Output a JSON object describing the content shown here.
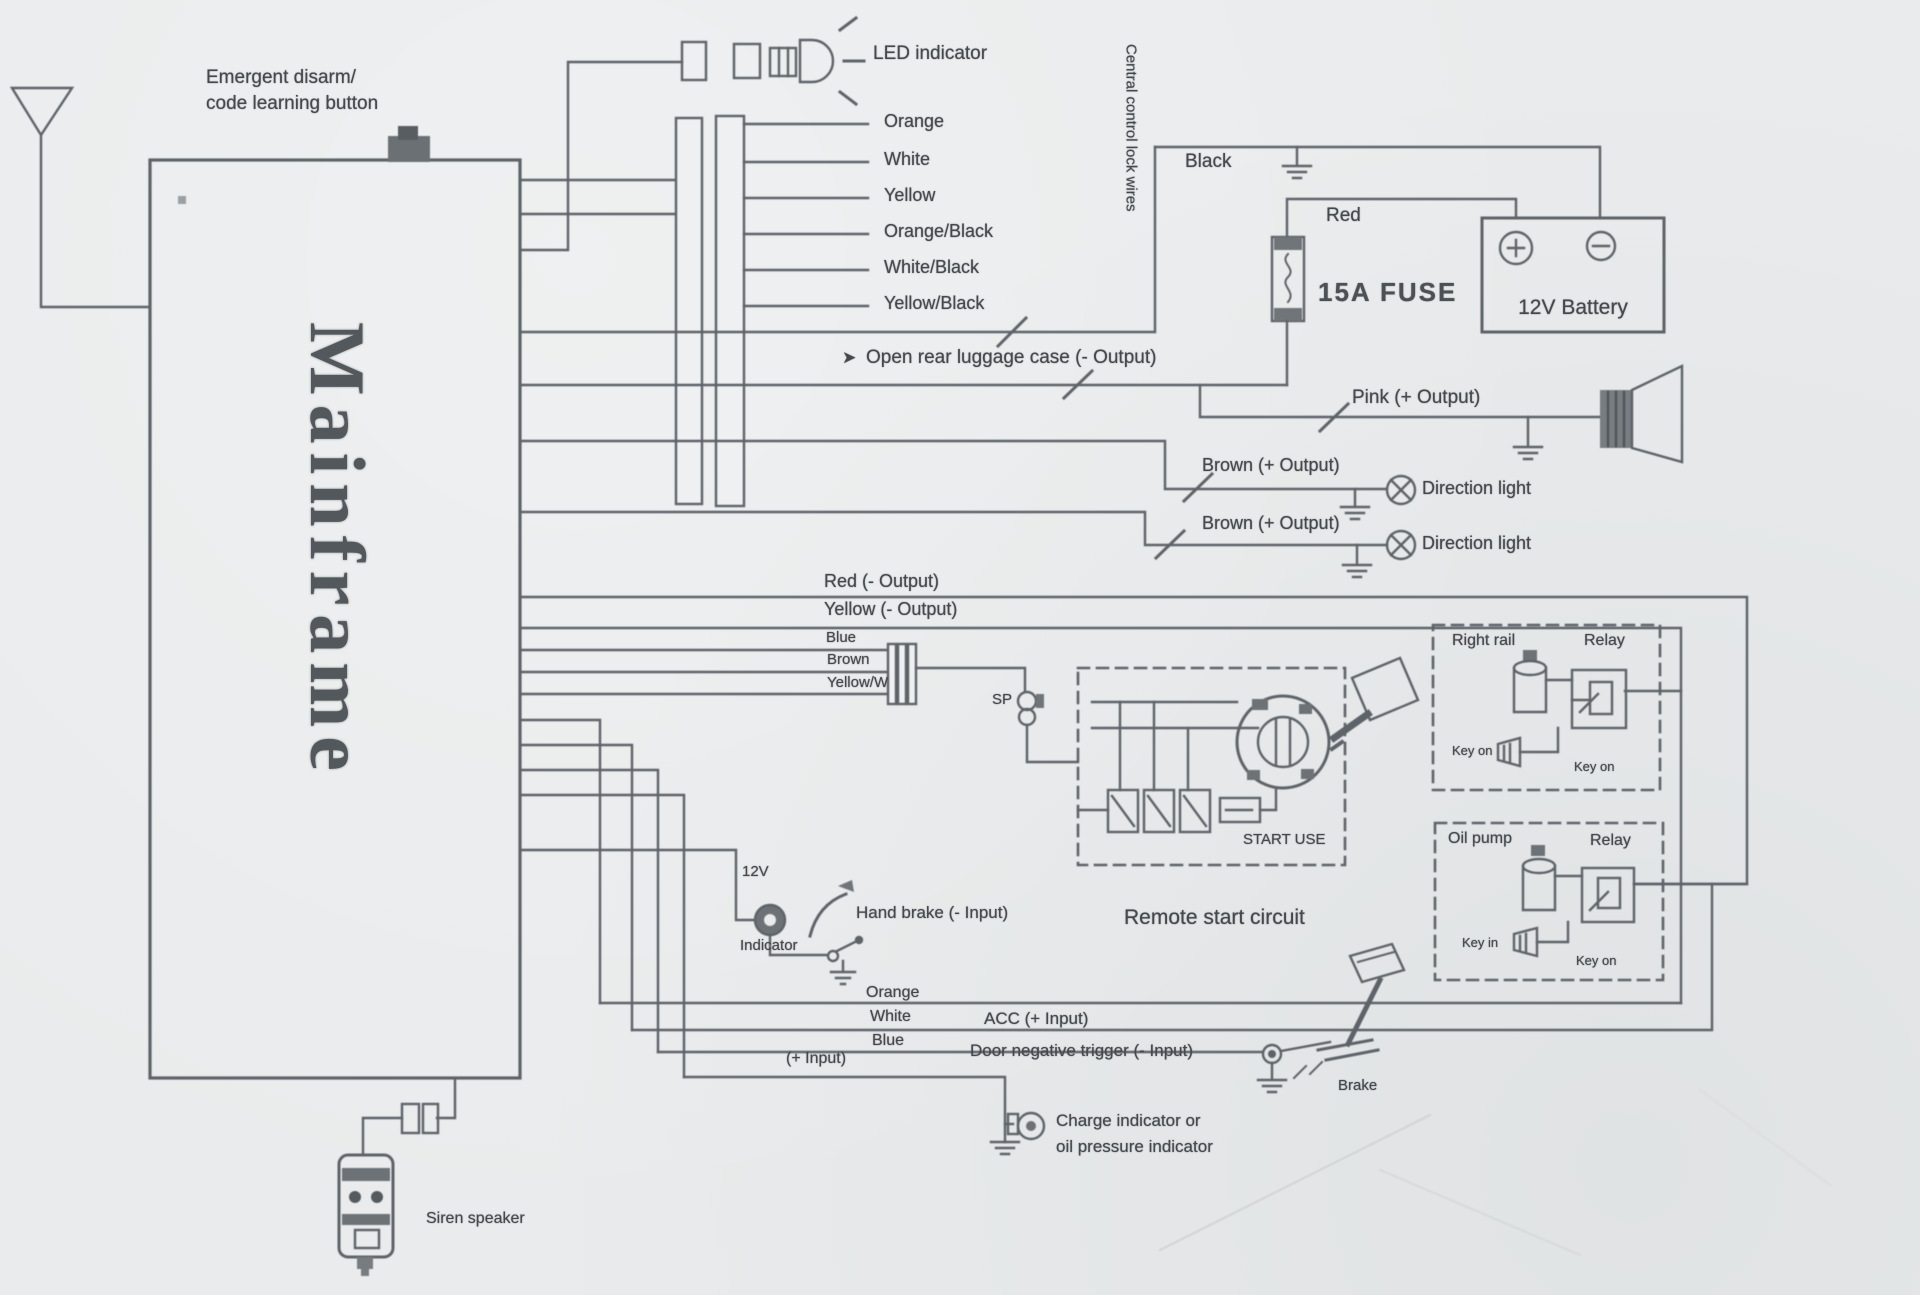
{
  "mainframe": {
    "title": "Mainframe",
    "button_caption_line1": "Emergent disarm/",
    "button_caption_line2": "code learning button"
  },
  "top_section": {
    "led_label": "LED indicator",
    "wire_labels": [
      "Orange",
      "White",
      "Yellow",
      "Orange/Black",
      "White/Black",
      "Yellow/Black"
    ],
    "central_lock_label": "Central control lock wires"
  },
  "power_section": {
    "black_label": "Black",
    "red_label": "Red",
    "fuse_label": "15A FUSE",
    "battery_label": "12V Battery"
  },
  "output_section": {
    "luggage_arrow": "➤",
    "luggage_label": "Open rear luggage case (- Output)",
    "pink_label": "Pink (+ Output)",
    "brown_label_1": "Brown (+ Output)",
    "brown_label_2": "Brown (+ Output)",
    "direction_light_1": "Direction light",
    "direction_light_2": "Direction light"
  },
  "mid_section": {
    "red_output": "Red (- Output)",
    "yellow_output": "Yellow (- Output)",
    "blue": "Blue",
    "brown": "Brown",
    "yellow_w": "Yellow/W",
    "sp": "SP"
  },
  "remote_start": {
    "caption": "Remote start circuit",
    "inner_text": "START USE"
  },
  "relay_box_top": {
    "name": "Right rail",
    "relay": "Relay",
    "key_left": "Key on",
    "key_right": "Key on"
  },
  "relay_box_bottom": {
    "name": "Oil pump",
    "relay": "Relay",
    "key_left": "Key in",
    "key_right": "Key on"
  },
  "bottom_section": {
    "twelve_v": "12V",
    "indicator": "Indicator",
    "hand_brake": "Hand brake (- Input)",
    "orange": "Orange",
    "white": "White",
    "acc": "ACC  (+ Input)",
    "blue": "Blue",
    "door_trigger": "Door negative trigger (- Input)",
    "plus_input": "(+ Input)",
    "brake": "Brake",
    "charge_line1": "Charge indicator or",
    "charge_line2": "oil pressure indicator",
    "siren": "Siren speaker"
  }
}
